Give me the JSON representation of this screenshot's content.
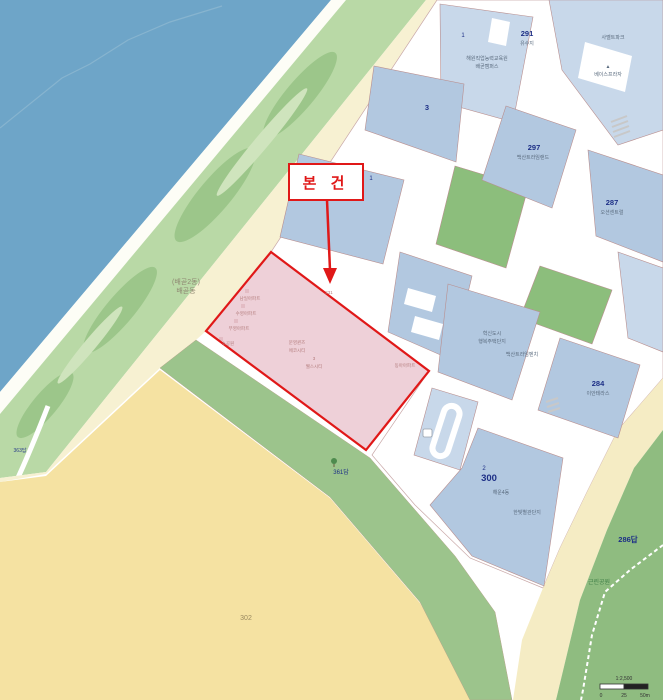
{
  "map": {
    "annotation": {
      "label": "본 건"
    },
    "colors": {
      "water": "#6ea5c8",
      "beach": "#fdfdf6",
      "coast_green": "#b9d9a6",
      "coast_green_dark": "#9cc68a",
      "cream_strip": "#f7f1d2",
      "field_yellow": "#f5e2a2",
      "green_band": "#9cc48c",
      "park_green": "#8fbc80",
      "sand_band": "#f5ecc4",
      "parcel_blue": "#b2c8e0",
      "parcel_blue_light": "#c8d8ea",
      "parcel_green": "#8cbe7c",
      "road_white": "#ffffff",
      "subject_fill": "#eac6d0",
      "subject_border": "#e01818",
      "cadastral_line": "#b98f8f",
      "label_navy": "#1d2f86"
    },
    "scale_bar": {
      "ratio_text": "1:2,500",
      "ticks": [
        "0",
        "25",
        "50m"
      ]
    },
    "labels": [
      {
        "t": "본 건",
        "x": 326,
        "y": 188,
        "cls": "subject"
      },
      {
        "t": "291",
        "x": 527,
        "y": 36,
        "cls": "num-md"
      },
      {
        "t": "유수지",
        "x": 527,
        "y": 45,
        "cls": "tiny"
      },
      {
        "t": "사벨트파크",
        "x": 613,
        "y": 39,
        "cls": "tiny"
      },
      {
        "t": "▲",
        "x": 608,
        "y": 68,
        "cls": "tiny"
      },
      {
        "t": "베이스프라자",
        "x": 608,
        "y": 76,
        "cls": "tiny"
      },
      {
        "t": "1",
        "x": 463,
        "y": 37,
        "cls": "num-sm"
      },
      {
        "t": "해원직업능력교육원",
        "x": 487,
        "y": 60,
        "cls": "tiny"
      },
      {
        "t": "배곧캠퍼스",
        "x": 487,
        "y": 68,
        "cls": "tiny"
      },
      {
        "t": "3",
        "x": 427,
        "y": 110,
        "cls": "num-md"
      },
      {
        "t": "297",
        "x": 534,
        "y": 150,
        "cls": "num-md"
      },
      {
        "t": "백산트라임랜드",
        "x": 533,
        "y": 159,
        "cls": "tiny"
      },
      {
        "t": "287",
        "x": 612,
        "y": 205,
        "cls": "num-md"
      },
      {
        "t": "오션센트럴",
        "x": 612,
        "y": 214,
        "cls": "tiny"
      },
      {
        "t": "1",
        "x": 371,
        "y": 180,
        "cls": "num-sm"
      },
      {
        "t": "혁신도시",
        "x": 492,
        "y": 335,
        "cls": "tiny"
      },
      {
        "t": "행복주택단지",
        "x": 492,
        "y": 343,
        "cls": "tiny"
      },
      {
        "t": "백산트라임벤치",
        "x": 522,
        "y": 356,
        "cls": "tiny"
      },
      {
        "t": "284",
        "x": 598,
        "y": 386,
        "cls": "num-md"
      },
      {
        "t": "이안테라스",
        "x": 598,
        "y": 395,
        "cls": "tiny"
      },
      {
        "t": "2",
        "x": 484,
        "y": 470,
        "cls": "num-sm"
      },
      {
        "t": "300",
        "x": 489,
        "y": 481,
        "cls": "num-lg"
      },
      {
        "t": "해운4동",
        "x": 501,
        "y": 494,
        "cls": "tiny"
      },
      {
        "t": "한빛별관단지",
        "x": 527,
        "y": 514,
        "cls": "tiny"
      },
      {
        "t": "302",
        "x": 246,
        "y": 620,
        "cls": "num-brown"
      },
      {
        "t": "286답",
        "x": 628,
        "y": 542,
        "cls": "num-md"
      },
      {
        "t": "근린공원",
        "x": 599,
        "y": 584,
        "cls": "park"
      },
      {
        "t": "361답",
        "x": 341,
        "y": 474,
        "cls": "num-sm"
      },
      {
        "t": "363답",
        "x": 20,
        "y": 452,
        "cls": "num-xs"
      },
      {
        "t": "(배곧2동)",
        "x": 186,
        "y": 284,
        "cls": "place"
      },
      {
        "t": "배곧동",
        "x": 186,
        "y": 293,
        "cls": "place"
      },
      {
        "t": "남일아파트",
        "x": 250,
        "y": 300,
        "cls": "pink-tiny"
      },
      {
        "t": "수영아파트",
        "x": 246,
        "y": 315,
        "cls": "pink-tiny"
      },
      {
        "t": "부영아파트",
        "x": 239,
        "y": 330,
        "cls": "pink-tiny"
      },
      {
        "t": "소공원",
        "x": 228,
        "y": 345,
        "cls": "pink-tiny"
      },
      {
        "t": "문영퀸즈",
        "x": 297,
        "y": 344,
        "cls": "pink-tiny"
      },
      {
        "t": "에코시티",
        "x": 297,
        "y": 352,
        "cls": "pink-tiny"
      },
      {
        "t": "3",
        "x": 314,
        "y": 360,
        "cls": "pink-tiny"
      },
      {
        "t": "웰스시티",
        "x": 314,
        "y": 368,
        "cls": "pink-tiny"
      },
      {
        "t": "231",
        "x": 329,
        "y": 294,
        "cls": "pink-tiny"
      },
      {
        "t": "동아아파트",
        "x": 405,
        "y": 367,
        "cls": "pink-tiny"
      },
      {
        "t": "1:2,500",
        "x": 624,
        "y": 680,
        "cls": "scale"
      },
      {
        "t": "0",
        "x": 601,
        "y": 697,
        "cls": "scale"
      },
      {
        "t": "25",
        "x": 624,
        "y": 697,
        "cls": "scale"
      },
      {
        "t": "50m",
        "x": 645,
        "y": 697,
        "cls": "scale"
      }
    ]
  }
}
